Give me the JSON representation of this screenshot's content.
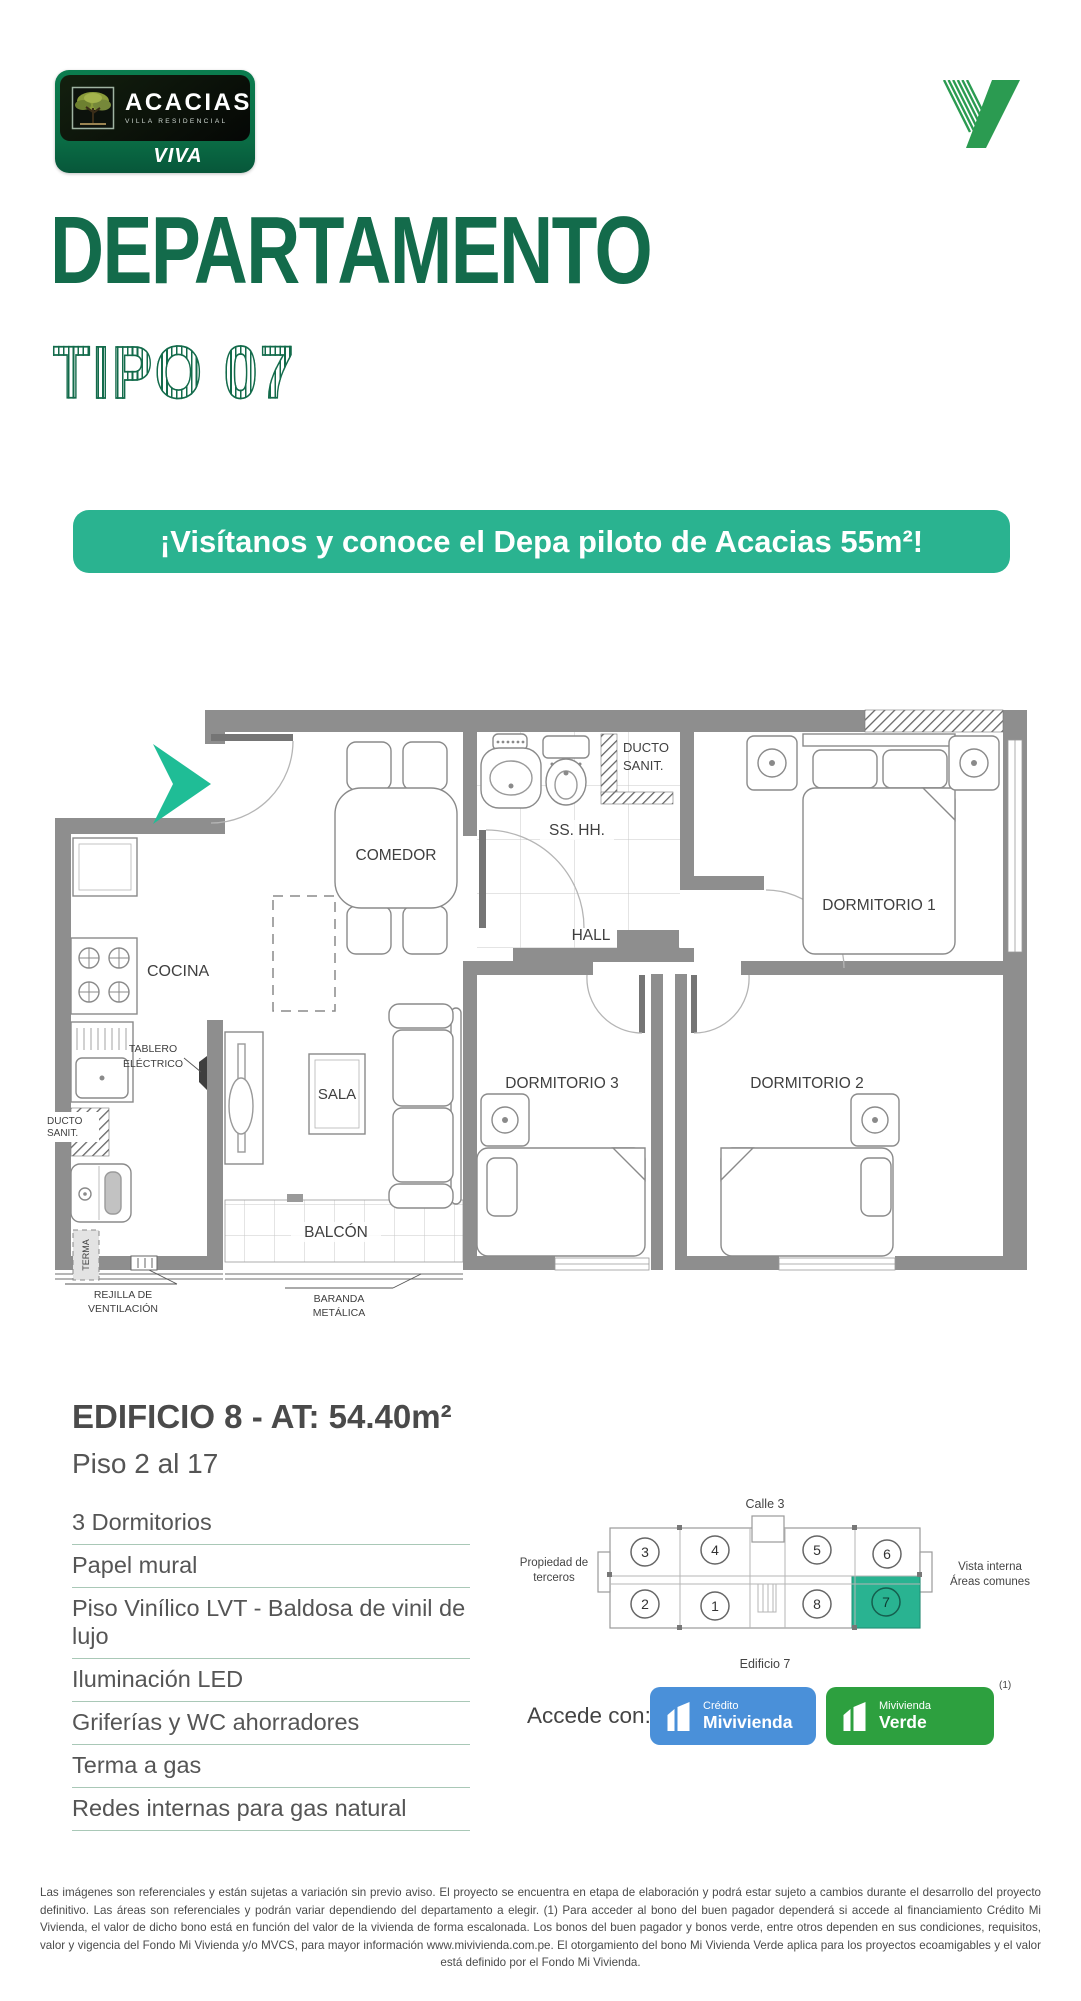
{
  "brand": {
    "name": "ACACIAS",
    "subtitle": "VILLA RESIDENCIAL",
    "badge": "VIVA"
  },
  "header": {
    "title": "DEPARTAMENTO",
    "type_label": "TIPO 07",
    "banner": "¡Visítanos y conoce el Depa piloto de Acacias 55m²!"
  },
  "floorplan": {
    "comedor": "COMEDOR",
    "sshh": "SS. HH.",
    "ducto_top_line1": "DUCTO",
    "ducto_top_line2": "SANIT.",
    "dormitorio1": "DORMITORIO 1",
    "hall": "HALL",
    "cocina": "COCINA",
    "ducto_left_line1": "DUCTO",
    "ducto_left_line2": "SANIT.",
    "tablero_line1": "TABLERO",
    "tablero_line2": "ELÉCTRICO",
    "sala": "SALA",
    "dormitorio3": "DORMITORIO 3",
    "dormitorio2": "DORMITORIO 2",
    "balcon": "BALCÓN",
    "terma": "TERMA",
    "rejilla_line1": "REJILLA DE",
    "rejilla_line2": "VENTILACIÓN",
    "baranda_line1": "BARANDA",
    "baranda_line2": "METÁLICA"
  },
  "details": {
    "building_title": "EDIFICIO 8 - AT: 54.40m²",
    "floors": "Piso 2 al 17",
    "features": [
      "3 Dormitorios",
      "Papel mural",
      "Piso Vinílico LVT - Baldosa de vinil de lujo",
      "Iluminación LED",
      "Griferías y WC ahorradores",
      "Terma a gas",
      "Redes internas para gas natural"
    ]
  },
  "keyplan": {
    "street": "Calle 3",
    "left_label_line1": "Propiedad de",
    "left_label_line2": "terceros",
    "right_label_line1": "Vista interna",
    "right_label_line2": "Áreas comunes",
    "building_label": "Edificio 7",
    "units_top": [
      "3",
      "4",
      "5",
      "6"
    ],
    "units_bottom": [
      "2",
      "1",
      "8",
      "7"
    ],
    "highlighted_unit": "7"
  },
  "access": {
    "label": "Accede con:",
    "note": "(1)",
    "badges": [
      {
        "line1": "Crédito",
        "line2": "Mivivienda",
        "color": "#4a90d9"
      },
      {
        "line1": "Mivivienda",
        "line2": "Verde",
        "color": "#2da03f"
      }
    ]
  },
  "footer": {
    "disclaimer": "Las imágenes son referenciales y están sujetas a variación sin previo aviso. El proyecto se encuentra en etapa de elaboración y podrá estar sujeto a cambios durante el desarrollo del proyecto definitivo. Las áreas son referenciales y podrán variar dependiendo del departamento a elegir. (1) Para acceder al bono del buen pagador dependerá si accede al financiamiento Crédito Mi Vivienda, el valor de dicho bono está en función del valor de la vivienda de forma escalonada. Los bonos del buen pagador y bonos verde, entre otros dependen en sus condiciones, requisitos, valor y vigencia del Fondo Mi Vivienda y/o MVCS, para mayor información www.mivivienda.com.pe. El otorgamiento del bono Mi Vivienda Verde aplica para los proyectos ecoamigables y el valor está definido por el Fondo Mi Vivienda."
  },
  "colors": {
    "brand_green": "#136b4b",
    "accent_teal": "#2ab390",
    "wall_gray": "#8e8e8e",
    "highlight_unit": "#29b391",
    "mivivienda_blue": "#4a90d9",
    "mivivienda_green": "#2da03f"
  }
}
